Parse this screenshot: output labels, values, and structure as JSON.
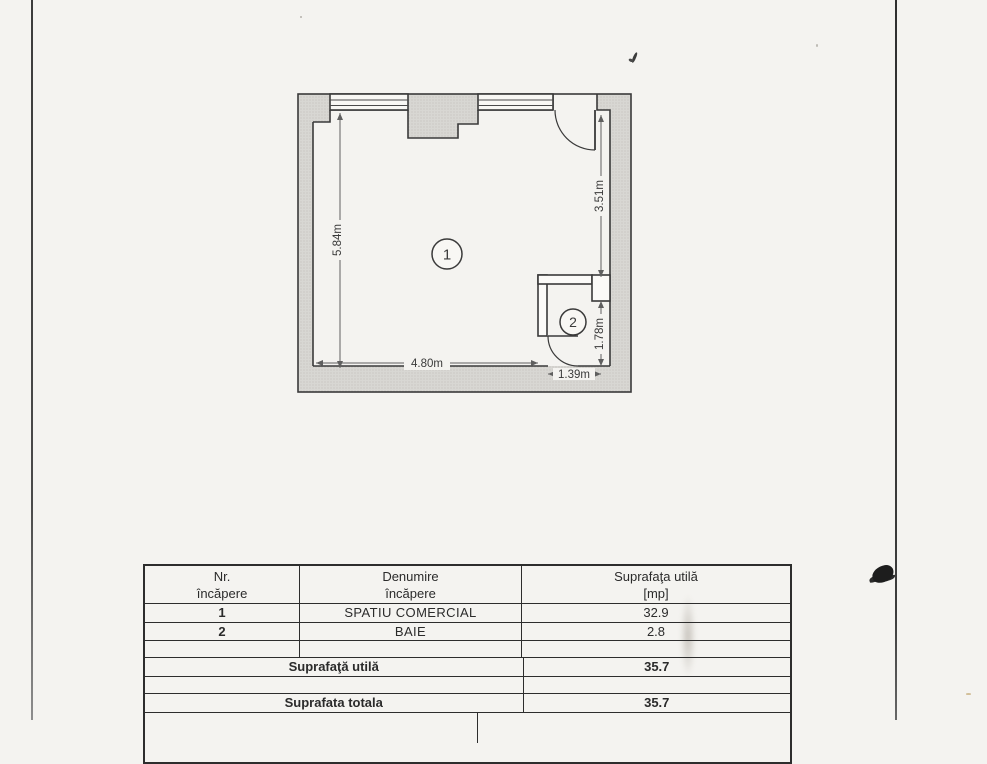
{
  "floor_plan": {
    "room_labels": [
      {
        "number": "1"
      },
      {
        "number": "2"
      }
    ],
    "dimensions": {
      "left_wall": "5.84m",
      "right_wall_upper": "3.51m",
      "bottom_wall": "4.80m",
      "bathroom_width": "1.39m",
      "bathroom_height": "1.78m"
    }
  },
  "table": {
    "header": {
      "col1": [
        "Nr.",
        "încăpere"
      ],
      "col2": [
        "Denumire",
        "încăpere"
      ],
      "col3": [
        "Suprafaţa utilă",
        "[mp]"
      ]
    },
    "rows": [
      {
        "nr": "1",
        "name": "SPATIU COMERCIAL",
        "area": "32.9"
      },
      {
        "nr": "2",
        "name": "BAIE",
        "area": "2.8"
      }
    ],
    "totals": {
      "usable": {
        "label": "Suprafaţă utilă",
        "value": "35.7"
      },
      "overall": {
        "label": "Suprafata totala",
        "value": "35.7"
      }
    }
  }
}
